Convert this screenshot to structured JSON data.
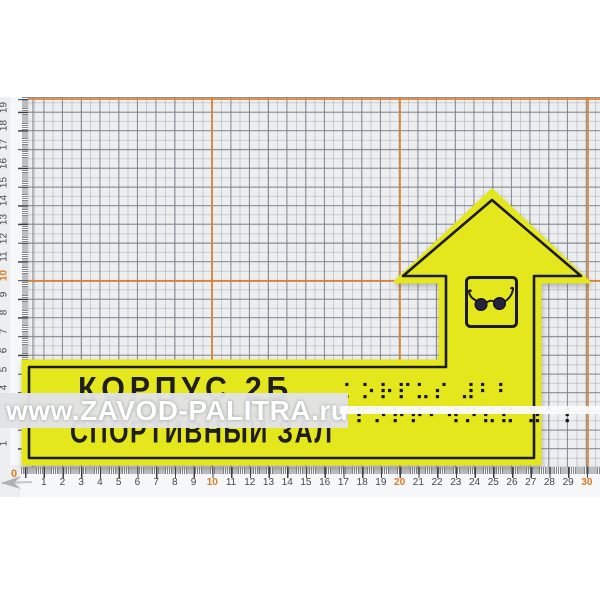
{
  "photo": {
    "watermark_text": "www.ZAVOD-PALITRA.ru"
  },
  "sign": {
    "text_line1": "КОРПУС 2Б",
    "text_line2": "СПОРТИВНЫЙ ЗАЛ",
    "braille_line1": "⠅⠕⠗⠏⠥⠎ ⠼⠃⠃",
    "braille_line2": "⠎⠏⠕⠗⠞⠊⠺⠝⠮⠯ ⠵⠁⠇",
    "icon": "dark-glasses-icon",
    "colors": {
      "plate_yellow": "#e5e71d",
      "outline_black": "#1b1b1b",
      "lens_navy": "#23233b"
    }
  },
  "mat": {
    "accent_orange": "#df8330",
    "orange_vertical_cm": [
      "10",
      "20",
      "30"
    ],
    "orange_horizontal_cm": [
      "10",
      "20"
    ]
  },
  "rulers": {
    "zero_label": "0",
    "bottom_numbers": [
      "1",
      "2",
      "3",
      "4",
      "5",
      "6",
      "7",
      "8",
      "9",
      "10",
      "11",
      "12",
      "13",
      "14",
      "15",
      "16",
      "17",
      "18",
      "19",
      "20",
      "21",
      "22",
      "23",
      "24",
      "25",
      "26",
      "27",
      "28",
      "29",
      "30"
    ],
    "bottom_orange": [
      "10",
      "20",
      "30"
    ],
    "left_numbers": [
      "1",
      "2",
      "3",
      "4",
      "5",
      "6",
      "7",
      "8",
      "9",
      "10",
      "11",
      "12",
      "13",
      "14",
      "15",
      "16",
      "17",
      "18",
      "19"
    ],
    "left_orange": [
      "10"
    ]
  }
}
